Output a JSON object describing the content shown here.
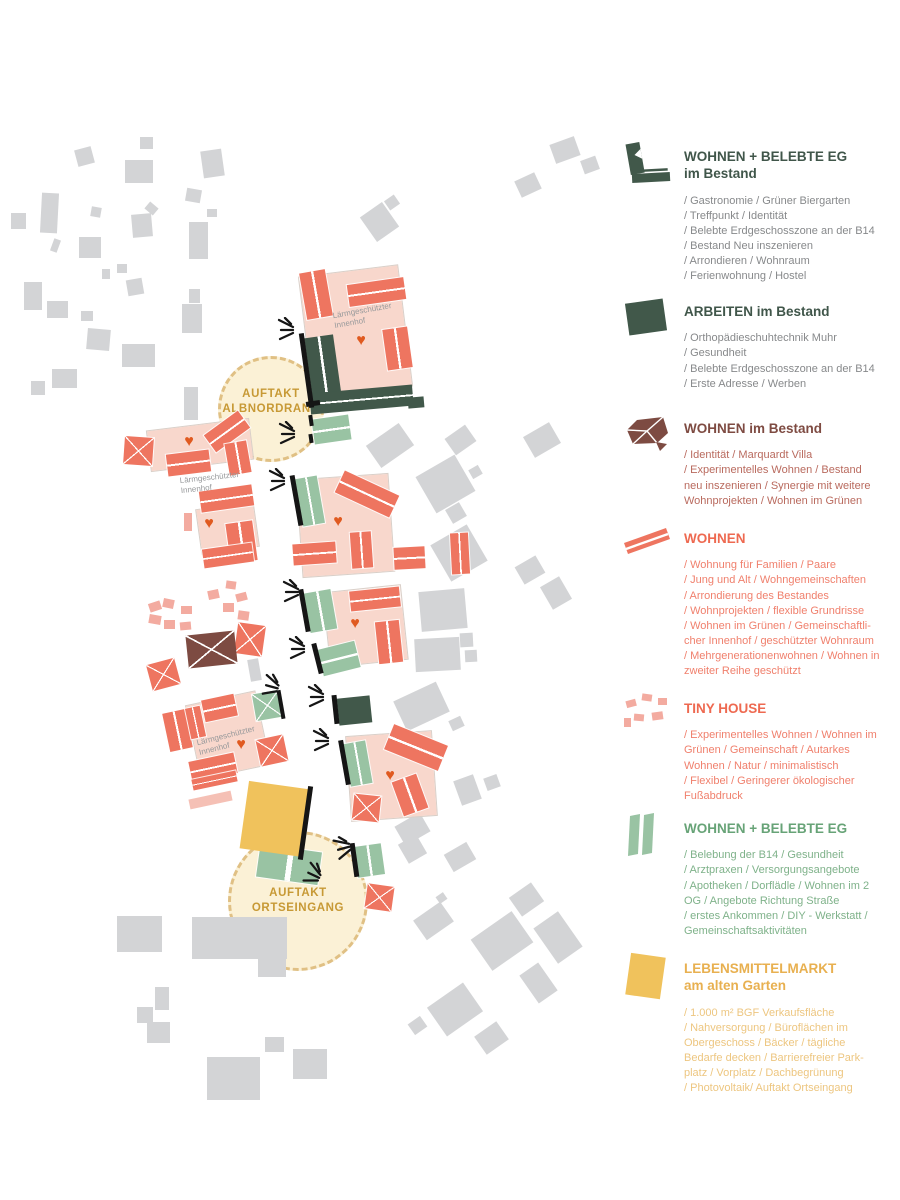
{
  "colors": {
    "salmon": "#ee7560",
    "pink": "#f8d7cc",
    "tiny_pink": "#f3aba0",
    "light_pink": "#f5c0b5",
    "dark_green": "#41584a",
    "light_green": "#99c3a3",
    "brown": "#7d4b42",
    "yellow": "#f0c25c",
    "gray_building": "#d3d4d6",
    "gold_text": "#c79935",
    "plaza_fill": "#fbf1d6",
    "plaza_rim": "#e0c084",
    "heart": "#e05a20",
    "label_gray": "#97999b"
  },
  "legend": {
    "items": [
      {
        "id": "wohnen-belebte-eg-bestand",
        "title": "WOHNEN + BELEBTE EG",
        "subtitle": "im Bestand",
        "title_color": "#40564a",
        "body_color": "#87898b",
        "icon_color": "#41584a",
        "icon": "dark-green-corner-building",
        "body": "/ Gastronomie / Grüner Biergarten\n/ Treffpunkt / Identität\n/ Belebte Erdgeschosszone an der B14\n/ Bestand Neu inszenieren\n/ Arrondieren / Wohnraum\n/ Ferienwohnung / Hostel"
      },
      {
        "id": "arbeiten-im-bestand",
        "title": "ARBEITEN im Bestand",
        "title_color": "#40564a",
        "body_color": "#87898b",
        "icon_color": "#41584a",
        "icon": "dark-green-square",
        "body": "/ Orthopädieschuhtechnik Muhr\n/ Gesundheit\n/  Belebte Erdgeschosszone an der B14\n/ Erste Adresse / Werben"
      },
      {
        "id": "wohnen-im-bestand",
        "title": "WOHNEN im Bestand",
        "title_color": "#7e4b42",
        "body_color": "#b96a5e",
        "icon_color": "#7d4b42",
        "icon": "brown-hip-roof",
        "body": "/ Identität / Marquardt Villa\n/ Experimentelles Wohnen / Bestand\nneu inszenieren / Synergie mit weitere\nWohnprojekten / Wohnen im Grünen"
      },
      {
        "id": "wohnen",
        "title": "WOHNEN",
        "title_color": "#ee6950",
        "body_color": "#f0806d",
        "icon_color": "#ee7560",
        "icon": "salmon-roof-bar",
        "body": "/ Wohnung für Familien / Paare\n/ Jung und Alt / Wohngemeinschaften\n/ Arrondierung des Bestandes\n/ Wohnprojekten / flexible Grundrisse\n/ Wohnen im Grünen / Gemeinschaftli-\ncher Innenhof / geschützter Wohnraum\n/ Mehrgenerationenwohnen / Wohnen in\nzweiter Reihe  geschützt"
      },
      {
        "id": "tiny-house",
        "title": "TINY HOUSE",
        "title_color": "#ee6950",
        "body_color": "#f0806d",
        "icon_color": "#f3aba0",
        "icon": "tiny-house-cluster",
        "body": "/ Experimentelles Wohnen / Wohnen im\nGrünen / Gemeinschaft / Autarkes\nWohnen / Natur / minimalistisch\n/ Flexibel / Geringerer ökologischer\nFußabdruck"
      },
      {
        "id": "wohnen-belebte-eg",
        "title": "WOHNEN + BELEBTE EG",
        "title_color": "#67a377",
        "body_color": "#7fb28a",
        "icon_color": "#99c3a3",
        "icon": "green-twin-bars",
        "body": " / Belebung der B14 / Gesundheit\n/ Arztpraxen / Versorgungsangebote\n/ Apotheken / Dorflädle / Wohnen im 2\nOG / Angebote Richtung Straße\n/ erstes Ankommen / DIY - Werkstatt /\nGemeinschaftsaktivitäten"
      },
      {
        "id": "lebensmittelmarkt",
        "title": "LEBENSMITTELMARKT",
        "subtitle": "am alten Garten",
        "title_color": "#e8b050",
        "body_color": "#edc680",
        "icon_color": "#f0c25c",
        "icon": "yellow-square",
        "body": " / 1.000 m² BGF Verkaufsfläche\n/ Nahversorgung / Büroflächen im\nObergeschoss / Bäcker / tägliche\nBedarfe decken / Barrierefreier Park-\nplatz / Vorplatz / Dachbegrünung\n/ Photovoltaik/ Auftakt Ortseingang"
      }
    ]
  },
  "map": {
    "plazas": [
      {
        "lines": [
          "AUFTAKT",
          "ALBNORDRAND"
        ],
        "cx": 271,
        "cy": 409,
        "r": 53,
        "dy": -7
      },
      {
        "lines": [
          "AUFTAKT",
          "ORTSEINGANG"
        ],
        "cx": 298,
        "cy": 901,
        "r": 70,
        "dy": 0
      }
    ],
    "courtyard_labels": [
      {
        "text": "Lärmgeschützter\nInnenhof",
        "x": 363,
        "y": 316,
        "rot": -10
      },
      {
        "text": "Lärmgeschützter\nInnenhof",
        "x": 210,
        "y": 483,
        "rot": -6
      },
      {
        "text": "Lärmgeschützter\nInnenhof",
        "x": 227,
        "y": 741,
        "rot": -14
      }
    ],
    "hearts": [
      [
        361,
        341
      ],
      [
        189,
        442
      ],
      [
        209,
        524
      ],
      [
        338,
        522
      ],
      [
        355,
        624
      ],
      [
        390,
        776
      ],
      [
        241,
        745
      ]
    ],
    "bursts": [
      [
        295,
        330,
        0
      ],
      [
        296,
        434,
        0
      ],
      [
        286,
        481,
        0
      ],
      [
        300,
        592,
        0
      ],
      [
        306,
        649,
        0
      ],
      [
        325,
        697,
        0
      ],
      [
        280,
        686,
        15
      ],
      [
        330,
        741,
        0
      ],
      [
        352,
        849,
        -15
      ],
      [
        322,
        874,
        25
      ]
    ],
    "shapes": [
      [
        76,
        148,
        17,
        17,
        -15,
        "context"
      ],
      [
        125,
        160,
        28,
        23,
        0,
        "context"
      ],
      [
        140,
        137,
        13,
        12,
        0,
        "context"
      ],
      [
        202,
        150,
        21,
        27,
        -8,
        "context"
      ],
      [
        41,
        193,
        17,
        40,
        3,
        "context"
      ],
      [
        11,
        213,
        15,
        16,
        0,
        "context"
      ],
      [
        186,
        189,
        15,
        13,
        10,
        "context"
      ],
      [
        146,
        204,
        11,
        9,
        40,
        "context"
      ],
      [
        91,
        207,
        10,
        10,
        10,
        "context"
      ],
      [
        207,
        209,
        10,
        8,
        0,
        "context"
      ],
      [
        132,
        214,
        20,
        23,
        -5,
        "context"
      ],
      [
        189,
        222,
        19,
        37,
        0,
        "context"
      ],
      [
        79,
        237,
        22,
        21,
        0,
        "context"
      ],
      [
        52,
        239,
        7,
        13,
        20,
        "context"
      ],
      [
        102,
        269,
        8,
        10,
        0,
        "context"
      ],
      [
        117,
        264,
        10,
        9,
        0,
        "context"
      ],
      [
        127,
        279,
        16,
        16,
        -10,
        "context"
      ],
      [
        24,
        282,
        18,
        28,
        0,
        "context"
      ],
      [
        47,
        301,
        21,
        17,
        0,
        "context"
      ],
      [
        81,
        311,
        12,
        10,
        0,
        "context"
      ],
      [
        189,
        289,
        11,
        14,
        0,
        "context"
      ],
      [
        182,
        304,
        20,
        29,
        0,
        "context"
      ],
      [
        87,
        329,
        23,
        21,
        5,
        "context"
      ],
      [
        122,
        344,
        33,
        23,
        0,
        "context"
      ],
      [
        52,
        369,
        25,
        19,
        0,
        "context"
      ],
      [
        31,
        381,
        14,
        14,
        0,
        "context"
      ],
      [
        184,
        387,
        14,
        33,
        0,
        "context"
      ],
      [
        366,
        207,
        27,
        30,
        -35,
        "context"
      ],
      [
        386,
        197,
        12,
        11,
        -35,
        "context"
      ],
      [
        552,
        140,
        26,
        20,
        -20,
        "context"
      ],
      [
        582,
        158,
        16,
        14,
        -20,
        "context"
      ],
      [
        517,
        176,
        22,
        18,
        -25,
        "context"
      ],
      [
        370,
        432,
        40,
        27,
        -35,
        "context"
      ],
      [
        448,
        430,
        25,
        20,
        -35,
        "context"
      ],
      [
        527,
        428,
        30,
        24,
        -30,
        "context"
      ],
      [
        423,
        463,
        45,
        42,
        -30,
        "context"
      ],
      [
        448,
        505,
        16,
        16,
        -30,
        "context"
      ],
      [
        470,
        467,
        11,
        10,
        -30,
        "context"
      ],
      [
        438,
        532,
        42,
        42,
        -30,
        "context"
      ],
      [
        518,
        560,
        24,
        20,
        -30,
        "context"
      ],
      [
        545,
        580,
        22,
        26,
        -30,
        "context"
      ],
      [
        420,
        590,
        46,
        40,
        -5,
        "context"
      ],
      [
        415,
        638,
        45,
        33,
        -3,
        "context"
      ],
      [
        460,
        633,
        13,
        14,
        -3,
        "context"
      ],
      [
        465,
        650,
        12,
        12,
        -3,
        "context"
      ],
      [
        398,
        690,
        47,
        33,
        -25,
        "context"
      ],
      [
        450,
        718,
        13,
        11,
        -25,
        "context"
      ],
      [
        457,
        777,
        21,
        26,
        -20,
        "context"
      ],
      [
        485,
        776,
        14,
        13,
        -20,
        "context"
      ],
      [
        398,
        818,
        29,
        22,
        -30,
        "context"
      ],
      [
        402,
        838,
        21,
        22,
        -30,
        "context"
      ],
      [
        447,
        847,
        26,
        20,
        -30,
        "context"
      ],
      [
        249,
        659,
        11,
        22,
        -10,
        "context"
      ],
      [
        117,
        916,
        45,
        36,
        0,
        "context"
      ],
      [
        192,
        917,
        95,
        42,
        0,
        "context"
      ],
      [
        258,
        955,
        28,
        22,
        0,
        "context"
      ],
      [
        155,
        987,
        14,
        23,
        0,
        "context"
      ],
      [
        137,
        1007,
        16,
        16,
        0,
        "context"
      ],
      [
        147,
        1022,
        23,
        21,
        0,
        "context"
      ],
      [
        265,
        1037,
        19,
        15,
        0,
        "context"
      ],
      [
        293,
        1049,
        34,
        30,
        0,
        "context"
      ],
      [
        207,
        1057,
        53,
        43,
        0,
        "context"
      ],
      [
        417,
        909,
        33,
        24,
        -35,
        "context"
      ],
      [
        437,
        894,
        9,
        8,
        -35,
        "context"
      ],
      [
        477,
        922,
        50,
        38,
        -35,
        "context"
      ],
      [
        513,
        888,
        27,
        23,
        -35,
        "context"
      ],
      [
        543,
        916,
        30,
        43,
        -35,
        "context"
      ],
      [
        527,
        966,
        23,
        34,
        -35,
        "context"
      ],
      [
        433,
        992,
        44,
        35,
        -35,
        "context"
      ],
      [
        410,
        1019,
        15,
        13,
        -35,
        "context"
      ],
      [
        478,
        1027,
        27,
        22,
        -35,
        "context"
      ],
      [
        306,
        271,
        99,
        121,
        -7,
        "pink"
      ],
      [
        149,
        425,
        102,
        40,
        -7,
        "pink"
      ],
      [
        199,
        506,
        57,
        44,
        -8,
        "pink"
      ],
      [
        300,
        477,
        91,
        97,
        -4,
        "pink"
      ],
      [
        327,
        589,
        77,
        74,
        -6,
        "pink"
      ],
      [
        349,
        734,
        85,
        84,
        -4,
        "pink"
      ],
      [
        193,
        698,
        70,
        74,
        -12,
        "pink"
      ],
      [
        189,
        795,
        43,
        10,
        -12,
        "lightpink"
      ],
      [
        149,
        602,
        12,
        9,
        -18,
        "tiny"
      ],
      [
        163,
        599,
        11,
        9,
        12,
        "tiny"
      ],
      [
        181,
        606,
        11,
        8,
        0,
        "tiny"
      ],
      [
        149,
        615,
        12,
        9,
        10,
        "tiny"
      ],
      [
        164,
        620,
        11,
        9,
        0,
        "tiny"
      ],
      [
        180,
        622,
        11,
        8,
        -5,
        "tiny"
      ],
      [
        208,
        590,
        11,
        9,
        -12,
        "tiny"
      ],
      [
        226,
        581,
        10,
        8,
        8,
        "tiny"
      ],
      [
        223,
        603,
        11,
        9,
        0,
        "tiny"
      ],
      [
        236,
        593,
        11,
        8,
        -15,
        "tiny"
      ],
      [
        238,
        611,
        11,
        9,
        8,
        "tiny"
      ],
      [
        184,
        513,
        8,
        18,
        0,
        "tiny"
      ],
      [
        303,
        271,
        26,
        47,
        -10,
        "salmon-v"
      ],
      [
        348,
        281,
        57,
        22,
        -8,
        "salmon-h"
      ],
      [
        385,
        328,
        25,
        41,
        -8,
        "salmon-v"
      ],
      [
        206,
        421,
        42,
        21,
        -36,
        "salmon-h"
      ],
      [
        227,
        442,
        22,
        32,
        -10,
        "salmon-v"
      ],
      [
        167,
        452,
        43,
        22,
        -7,
        "salmon-h"
      ],
      [
        124,
        437,
        29,
        28,
        4,
        "salmon-x"
      ],
      [
        200,
        488,
        53,
        21,
        -8,
        "salmon-h"
      ],
      [
        228,
        522,
        27,
        40,
        -8,
        "salmon-v"
      ],
      [
        203,
        546,
        50,
        19,
        -8,
        "salmon-h"
      ],
      [
        337,
        482,
        60,
        24,
        25,
        "salmon-h"
      ],
      [
        293,
        543,
        43,
        21,
        -4,
        "salmon-h"
      ],
      [
        351,
        532,
        21,
        36,
        -4,
        "salmon-v"
      ],
      [
        394,
        547,
        31,
        22,
        -3,
        "salmon-h"
      ],
      [
        451,
        533,
        18,
        41,
        -3,
        "salmon-v"
      ],
      [
        350,
        589,
        50,
        20,
        -6,
        "salmon-h"
      ],
      [
        377,
        621,
        24,
        42,
        -6,
        "salmon-v"
      ],
      [
        387,
        734,
        58,
        27,
        22,
        "salmon-h"
      ],
      [
        397,
        777,
        26,
        36,
        -20,
        "salmon-v"
      ],
      [
        353,
        795,
        27,
        26,
        6,
        "salmon-x"
      ],
      [
        166,
        711,
        23,
        39,
        -12,
        "salmon-v"
      ],
      [
        188,
        707,
        15,
        31,
        -12,
        "salmon-v"
      ],
      [
        203,
        697,
        33,
        22,
        -12,
        "salmon-h"
      ],
      [
        258,
        737,
        28,
        27,
        -12,
        "salmon-x"
      ],
      [
        190,
        757,
        46,
        21,
        -12,
        "salmon-h"
      ],
      [
        192,
        775,
        45,
        11,
        -12,
        "salmon-h"
      ],
      [
        236,
        624,
        28,
        31,
        8,
        "salmon-x"
      ],
      [
        149,
        661,
        29,
        27,
        -15,
        "salmon-x"
      ],
      [
        366,
        885,
        27,
        25,
        8,
        "salmon-x"
      ],
      [
        313,
        417,
        37,
        25,
        -8,
        "green-h"
      ],
      [
        299,
        477,
        22,
        48,
        -10,
        "green-v"
      ],
      [
        307,
        591,
        27,
        40,
        -10,
        "green-v"
      ],
      [
        320,
        645,
        38,
        27,
        -14,
        "green-h"
      ],
      [
        347,
        742,
        22,
        43,
        -10,
        "green-v"
      ],
      [
        254,
        692,
        27,
        27,
        -10,
        "green-x"
      ],
      [
        258,
        848,
        62,
        33,
        8,
        "green-v"
      ],
      [
        356,
        845,
        27,
        31,
        -8,
        "green-v"
      ],
      [
        309,
        336,
        29,
        70,
        -8,
        "dark-v"
      ],
      [
        310,
        389,
        103,
        21,
        -5,
        "dark-h"
      ],
      [
        408,
        397,
        16,
        11,
        -5,
        "dark"
      ],
      [
        338,
        697,
        33,
        27,
        -6,
        "dark"
      ],
      [
        187,
        633,
        49,
        33,
        -6,
        "brown-x"
      ],
      [
        244,
        785,
        64,
        68,
        8,
        "yellow"
      ],
      [
        304,
        333,
        5,
        75,
        -8,
        "black"
      ],
      [
        306,
        401,
        14,
        5,
        -8,
        "black"
      ],
      [
        309,
        415,
        4,
        11,
        -8,
        "black"
      ],
      [
        309,
        434,
        4,
        9,
        -8,
        "black"
      ],
      [
        294,
        475,
        5,
        51,
        -10,
        "black"
      ],
      [
        302,
        589,
        5,
        43,
        -10,
        "black"
      ],
      [
        315,
        643,
        5,
        31,
        -14,
        "black"
      ],
      [
        333,
        695,
        5,
        29,
        -6,
        "black"
      ],
      [
        342,
        740,
        5,
        45,
        -10,
        "black"
      ],
      [
        279,
        690,
        4,
        29,
        -10,
        "black"
      ],
      [
        303,
        786,
        5,
        74,
        8,
        "black"
      ],
      [
        352,
        843,
        5,
        34,
        -8,
        "black"
      ]
    ]
  }
}
